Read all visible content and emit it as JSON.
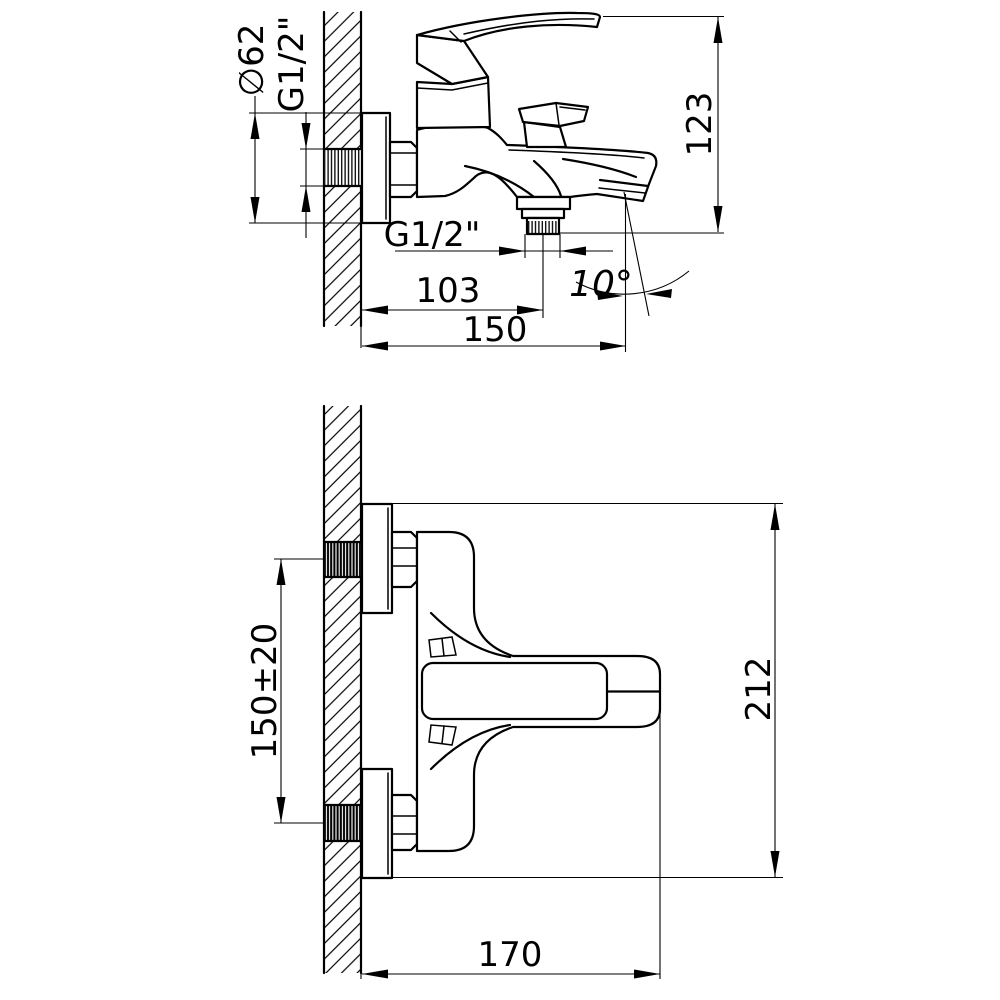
{
  "page": {
    "title": "Bath mixer installation drawing",
    "background_color": "#ffffff",
    "line_color": "#000000"
  },
  "views": {
    "side_view": {
      "name": "wall-mounted bath mixer - side view",
      "dims": {
        "flange_diameter": "∅62",
        "wall_thread": "G1/2\"",
        "body_height": "123",
        "outlet_thread": "G1/2\"",
        "outlet_offset": "103",
        "spout_reach": "150",
        "spout_angle": "10°"
      }
    },
    "plan_view": {
      "name": "wall-mounted bath mixer - plan view",
      "dims": {
        "inlet_spacing": "150±20",
        "overall_height": "212",
        "overall_reach": "170"
      }
    }
  }
}
